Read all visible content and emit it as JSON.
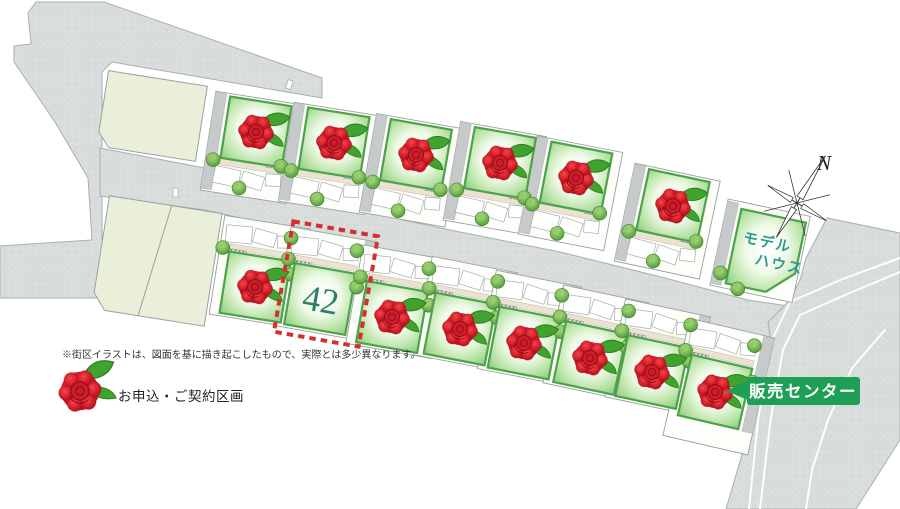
{
  "map": {
    "north_label": "N",
    "disclaimer": "※街区イラストは、図面を基に描き起こしたもので、実際とは多少異なります。",
    "legend": {
      "label": "お申込・ご契約区画",
      "symbol": "rose-icon"
    },
    "sales_center": {
      "label": "販売センター",
      "color": "#1f9e55"
    },
    "model_house": {
      "line1": "モデル",
      "line2": "ハウス",
      "text_color": "#2d9a90"
    },
    "highlight_lot": {
      "number": "42",
      "border_color": "#d53030",
      "number_color": "#2e7f68"
    },
    "colors": {
      "road": "#d8dcdb",
      "vacant_lot": "#e9efd8",
      "lawn_border": "#4da24b",
      "rose_red": "#c8141f",
      "driveway": "#c6caca"
    },
    "lots": [
      {
        "row": "top",
        "cx": 256,
        "cy": 132,
        "rot": 9,
        "contracted": true
      },
      {
        "row": "top",
        "cx": 334,
        "cy": 143,
        "rot": 9,
        "contracted": true
      },
      {
        "row": "top",
        "cx": 416,
        "cy": 155,
        "rot": 10,
        "contracted": true
      },
      {
        "row": "top",
        "cx": 500,
        "cy": 163,
        "rot": 10,
        "contracted": true
      },
      {
        "row": "top",
        "cx": 576,
        "cy": 178,
        "rot": 11,
        "contracted": true
      },
      {
        "row": "top",
        "cx": 673,
        "cy": 206,
        "rot": 12,
        "contracted": true
      },
      {
        "row": "top",
        "cx": 766,
        "cy": 252,
        "rot": 12,
        "contracted": false,
        "variant": "model-house"
      },
      {
        "row": "bottom",
        "cx": 255,
        "cy": 287,
        "rot": 9,
        "contracted": true
      },
      {
        "row": "bottom",
        "cx": 320,
        "cy": 299,
        "rot": 10,
        "contracted": false,
        "variant": "highlight",
        "number": "42"
      },
      {
        "row": "bottom",
        "cx": 392,
        "cy": 317,
        "rot": 10,
        "contracted": true
      },
      {
        "row": "bottom",
        "cx": 460,
        "cy": 329,
        "rot": 11,
        "contracted": true
      },
      {
        "row": "bottom",
        "cx": 524,
        "cy": 343,
        "rot": 11,
        "contracted": true
      },
      {
        "row": "bottom",
        "cx": 590,
        "cy": 358,
        "rot": 12,
        "contracted": true
      },
      {
        "row": "bottom",
        "cx": 652,
        "cy": 372,
        "rot": 12,
        "contracted": true
      },
      {
        "row": "bottom",
        "cx": 715,
        "cy": 392,
        "rot": 13,
        "contracted": true,
        "variant": "sales-center"
      }
    ]
  }
}
